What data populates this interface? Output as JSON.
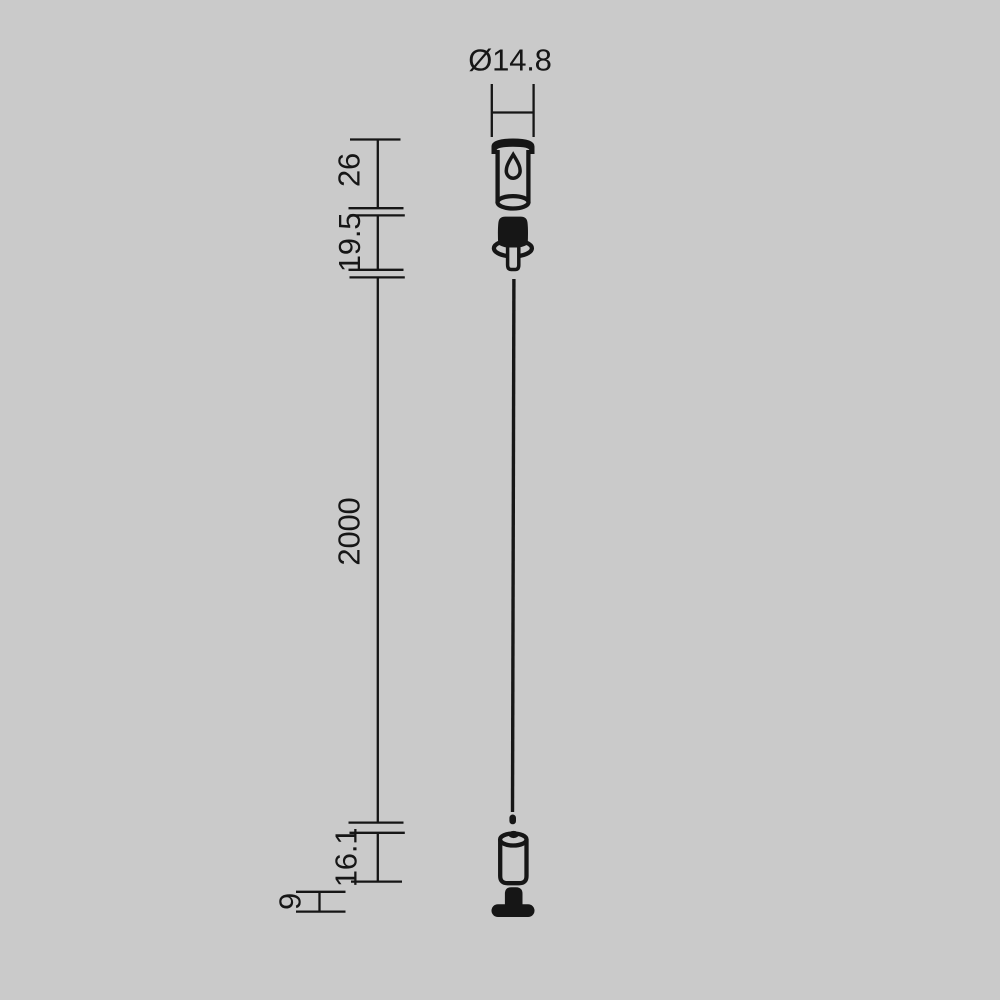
{
  "drawing": {
    "background_color": "#cacaca",
    "line_color": "#161616",
    "labels": {
      "diameter": "Ø14.8",
      "canopy_height": "26",
      "gripper_height": "19.5",
      "cable_length": "2000",
      "end_fitting_height": "16.1",
      "base_height": "9"
    }
  }
}
